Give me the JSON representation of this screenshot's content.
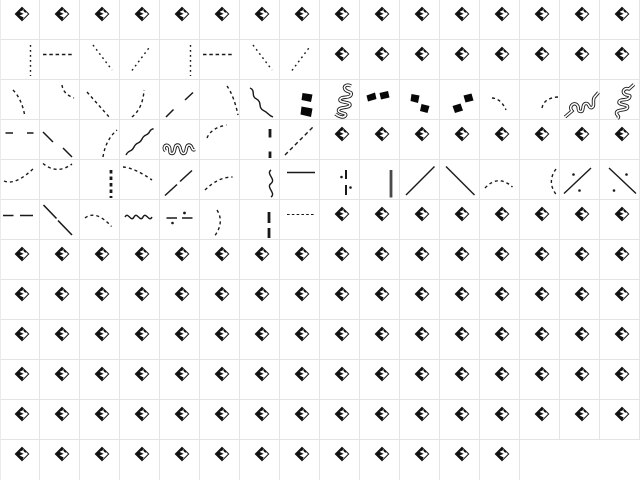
{
  "window": {
    "background_color": "#ffffff",
    "grid_line_color": "#e4e4e4",
    "glyph_color": "#191919",
    "vbar_color": "#4a4a4a"
  },
  "grid": {
    "columns": 16,
    "rows": 12,
    "cell_size": 40,
    "cells": [
      [
        "notdef",
        "notdef",
        "notdef",
        "notdef",
        "notdef",
        "notdef",
        "notdef",
        "notdef",
        "notdef",
        "notdef",
        "notdef",
        "notdef",
        "notdef",
        "notdef",
        "notdef",
        "notdef"
      ],
      [
        "dotted-vline",
        "dashed-hline",
        "dotted-diag-down",
        "dotted-diag-up",
        "dotted-vline",
        "dashed-hline",
        "dotted-diag-down",
        "dotted-diag-up",
        "notdef",
        "notdef",
        "notdef",
        "notdef",
        "notdef",
        "notdef",
        "notdef",
        "notdef"
      ],
      [
        "dashed-curve-s",
        "dashed-curve-se",
        "dashed-diag-down",
        "dashed-curve-ne",
        "broken-diag-up",
        "dashed-curve-s-long",
        "squiggle-diag-down",
        "brush-dashes-v",
        "meander-v",
        "brush-dashes-h",
        "brush-dashes-down",
        "brush-dashes-up",
        "dashed-arc-down-right",
        "dashed-arc-up-right",
        "meander-diag",
        "meander-v2"
      ],
      [
        "double-dash-h",
        "broken-diag-down",
        "dashed-curve-n",
        "wave-diag-up",
        "meander-h",
        "dashed-arc-rise",
        "thick-broken-vline",
        "dashed-diag-up-long",
        "notdef",
        "notdef",
        "notdef",
        "notdef",
        "notdef",
        "notdef",
        "notdef",
        "notdef"
      ],
      [
        "dashed-curve-rise",
        "dashed-smile",
        "thick-dashed-vline",
        "dashed-curve-fall",
        "broken-solid-diag-up",
        "dashed-curve-flat",
        "squiggle-vline",
        "solid-hline",
        "dashdot-vline",
        "solid-vbar",
        "solid-diag-up",
        "solid-diag-down",
        "dashed-hill",
        "dashed-paren-left",
        "dashdot-diag-up",
        "dashdot-diag-down"
      ],
      [
        "long-dashes-h",
        "solid-diag-down-broken",
        "dashed-hill-low",
        "wave-hline",
        "dashdot-hline",
        "dashed-paren-right",
        "thick-broken-vline2",
        "fine-dashed-hline",
        "notdef",
        "notdef",
        "notdef",
        "notdef",
        "notdef",
        "notdef",
        "notdef",
        "notdef"
      ],
      [
        "notdef",
        "notdef",
        "notdef",
        "notdef",
        "notdef",
        "notdef",
        "notdef",
        "notdef",
        "notdef",
        "notdef",
        "notdef",
        "notdef",
        "notdef",
        "notdef",
        "notdef",
        "notdef"
      ],
      [
        "notdef",
        "notdef",
        "notdef",
        "notdef",
        "notdef",
        "notdef",
        "notdef",
        "notdef",
        "notdef",
        "notdef",
        "notdef",
        "notdef",
        "notdef",
        "notdef",
        "notdef",
        "notdef"
      ],
      [
        "notdef",
        "notdef",
        "notdef",
        "notdef",
        "notdef",
        "notdef",
        "notdef",
        "notdef",
        "notdef",
        "notdef",
        "notdef",
        "notdef",
        "notdef",
        "notdef",
        "notdef",
        "notdef"
      ],
      [
        "notdef",
        "notdef",
        "notdef",
        "notdef",
        "notdef",
        "notdef",
        "notdef",
        "notdef",
        "notdef",
        "notdef",
        "notdef",
        "notdef",
        "notdef",
        "notdef",
        "notdef",
        "notdef"
      ],
      [
        "notdef",
        "notdef",
        "notdef",
        "notdef",
        "notdef",
        "notdef",
        "notdef",
        "notdef",
        "notdef",
        "notdef",
        "notdef",
        "notdef",
        "notdef",
        "notdef",
        "notdef",
        "notdef"
      ],
      [
        "notdef",
        "notdef",
        "notdef",
        "notdef",
        "notdef",
        "notdef",
        "notdef",
        "notdef",
        "notdef",
        "notdef",
        "notdef",
        "notdef",
        "notdef",
        "empty",
        "empty",
        "empty"
      ]
    ]
  },
  "icons": {
    "notdef": "missing-glyph-icon",
    "empty": "blank-cell"
  }
}
